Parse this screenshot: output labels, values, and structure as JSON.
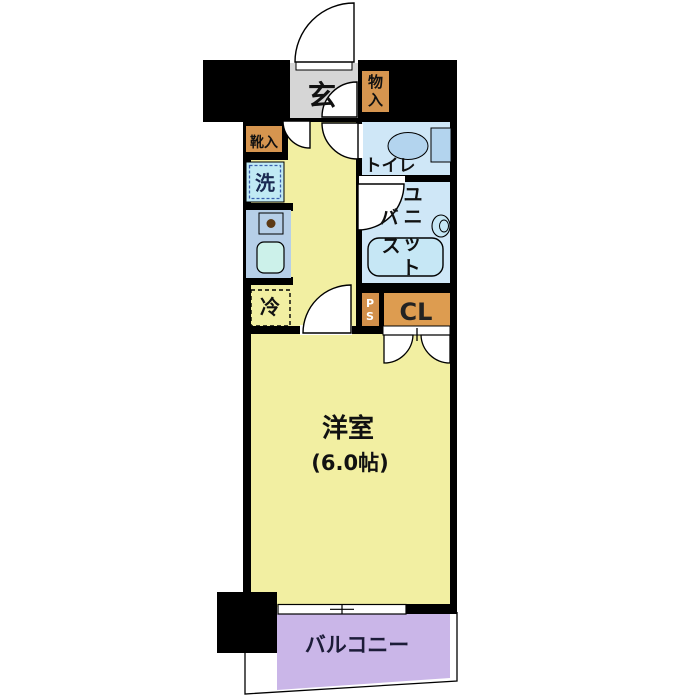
{
  "floor_plan": {
    "entrance": "玄",
    "storage_upper_col": [
      "物",
      "入"
    ],
    "shoe_storage": "靴入",
    "washer": "洗",
    "toilet": "トイレ",
    "unit_bath_col_right": [
      "ユ",
      "ニ",
      "ッ",
      "ト"
    ],
    "unit_bath_col_left": [
      "バ",
      "ス"
    ],
    "fridge": "冷",
    "pipe_space_col": [
      "P",
      "S"
    ],
    "closet": "CL",
    "main_room": "洋室",
    "main_room_size": "(6.0帖)",
    "balcony": "バルコニー"
  },
  "colors": {
    "wall": "#000000",
    "room_yellow": "#f2efa2",
    "entrance_gray": "#d6d6d6",
    "wet_area_blue": "#cfe7f7",
    "fixture_blue": "#b3d4ee",
    "kitchen_counter_blue": "#b6cfe8",
    "sink_mint": "#ccf1ea",
    "washer_blue": "#c0eaf4",
    "washer_dash_blue": "#3a5fae",
    "storage_orange": "#d6954f",
    "closet_orange": "#dd9c50",
    "balcony_purple": "#cab6e8",
    "burner_brown": "#5c3a16",
    "text_dark": "#111111",
    "balcony_text": "#1c1c38"
  }
}
